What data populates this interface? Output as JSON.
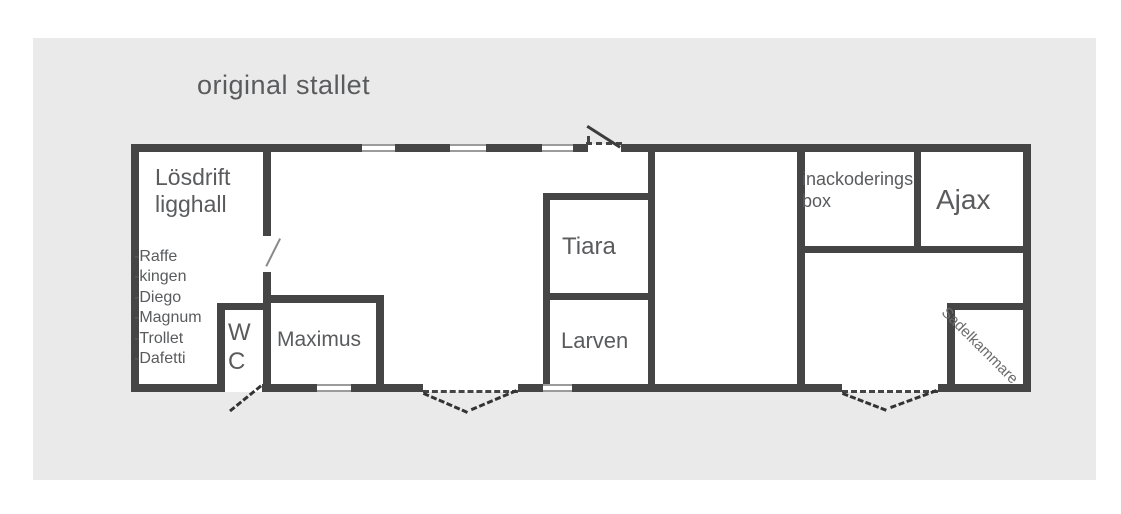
{
  "title": "original stallet",
  "building": {
    "losdrift": {
      "line1": "Lösdrift",
      "line2": "ligghall"
    },
    "horses": [
      "-Raffe",
      "-kingen",
      "-Diego",
      "-Magnum",
      "-Trollet",
      "-Dafetti"
    ],
    "wc_label": "W C",
    "maximus_label": "Maximus",
    "tiara_label": "Tiara",
    "larven_label": "Larven",
    "inack": {
      "line1": "inackoderings",
      "line2": "box"
    },
    "ajax_label": "Ajax",
    "sadel_label": "Sadelkammare"
  },
  "colors": {
    "wall": "#454545",
    "canvas_background": "#eaeaea",
    "text": "#5a5b5d",
    "window_line": "#9b9b9b"
  }
}
